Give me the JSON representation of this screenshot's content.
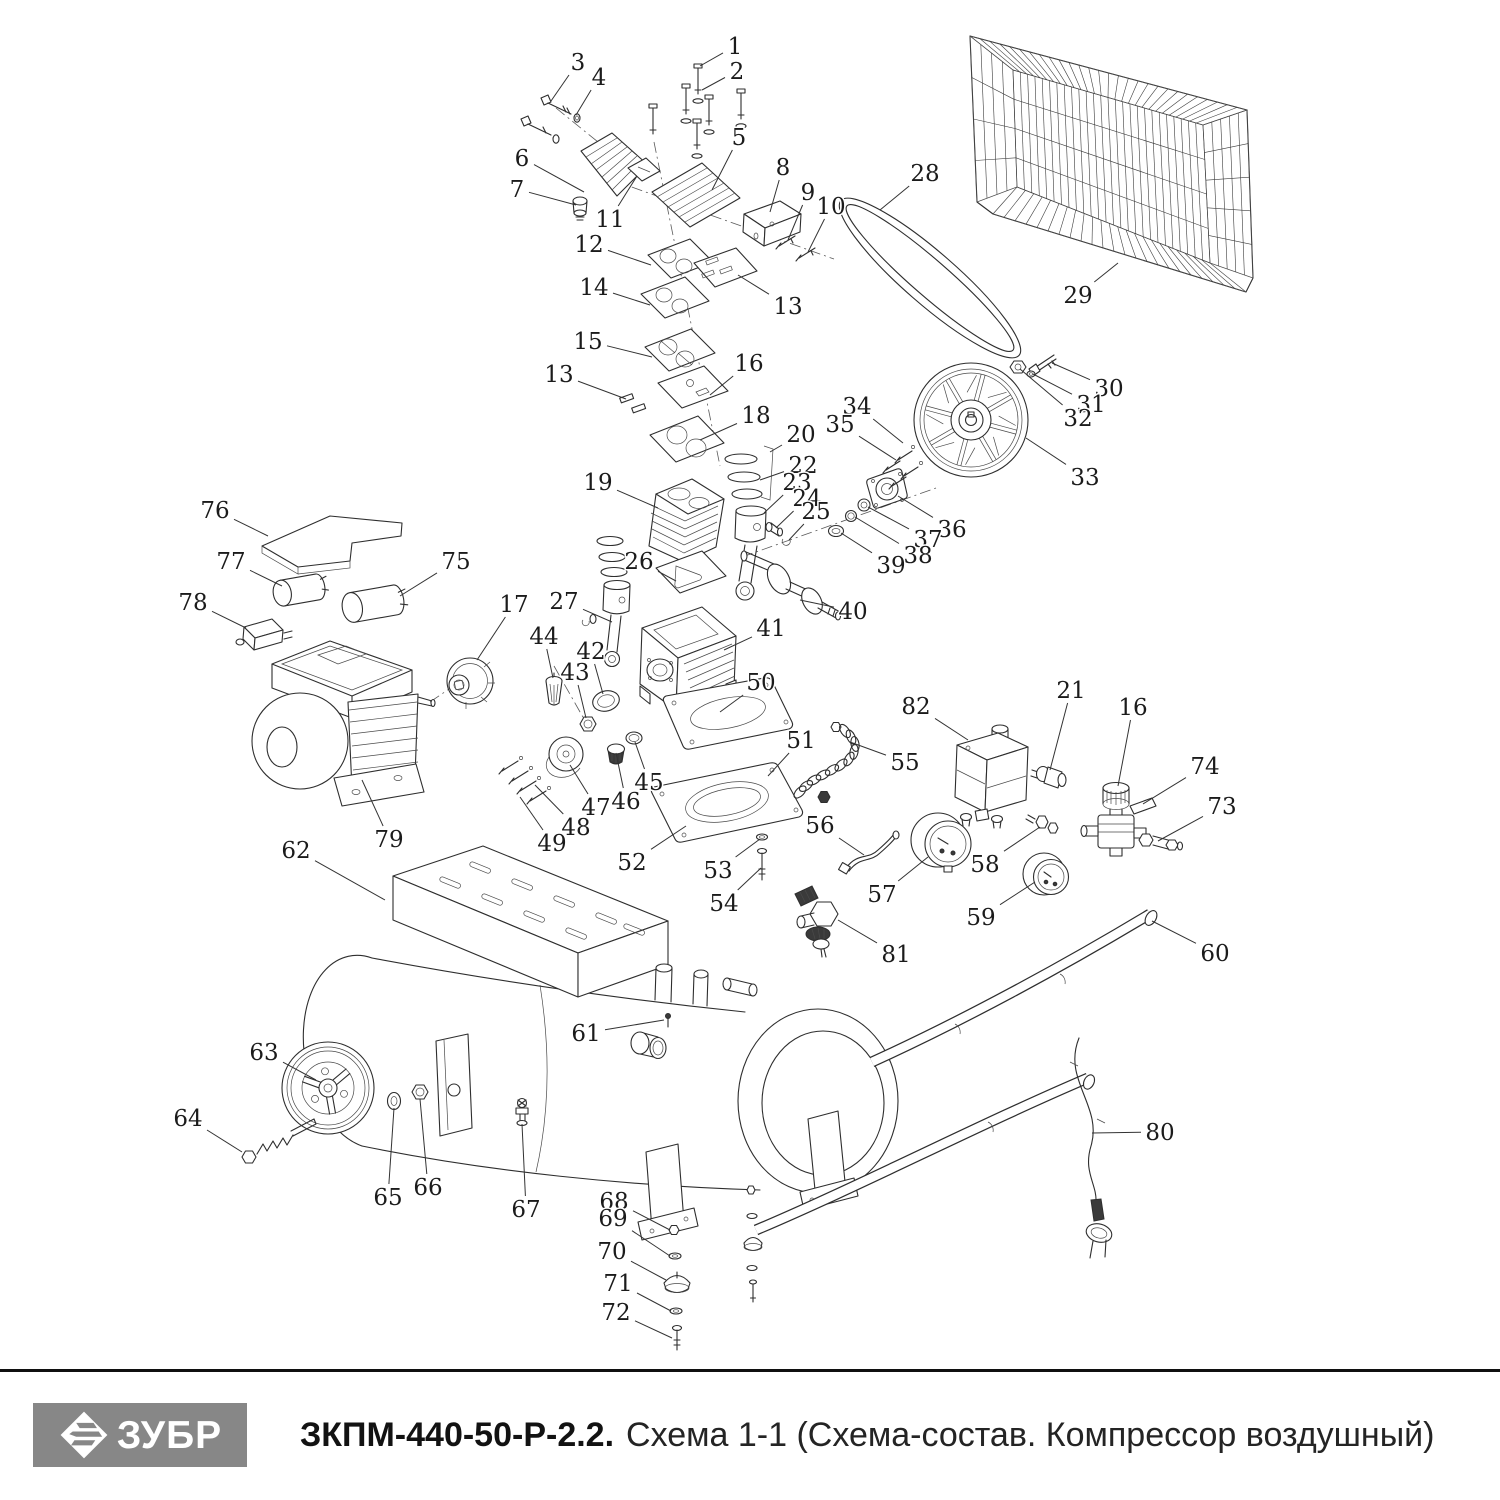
{
  "footer": {
    "brand": "ЗУБР",
    "model": "ЗКПМ-440-50-Р-2.2.",
    "subtitle": "Схема 1-1 (Схема-состав. Компрессор воздушный)"
  },
  "colors": {
    "line": "#2e2e2e",
    "label": "#1b1b1b",
    "logo_bg": "#878787",
    "rule": "#101010"
  },
  "diagram": {
    "description": "Exploded parts view of air compressor",
    "parts": [
      {
        "n": "1",
        "x": 735,
        "y": 46,
        "tx": 700,
        "ty": 66
      },
      {
        "n": "2",
        "x": 737,
        "y": 71,
        "tx": 702,
        "ty": 90
      },
      {
        "n": "3",
        "x": 578,
        "y": 62,
        "tx": 551,
        "ty": 101
      },
      {
        "n": "4",
        "x": 599,
        "y": 77,
        "tx": 576,
        "ty": 115
      },
      {
        "n": "5",
        "x": 739,
        "y": 137,
        "tx": 712,
        "ty": 190
      },
      {
        "n": "6",
        "x": 522,
        "y": 158,
        "tx": 584,
        "ty": 192
      },
      {
        "n": "7",
        "x": 517,
        "y": 189,
        "tx": 576,
        "ty": 205
      },
      {
        "n": "8",
        "x": 783,
        "y": 167,
        "tx": 770,
        "ty": 212
      },
      {
        "n": "9",
        "x": 808,
        "y": 192,
        "tx": 788,
        "ty": 240
      },
      {
        "n": "10",
        "x": 831,
        "y": 206,
        "tx": 808,
        "ty": 252
      },
      {
        "n": "11",
        "x": 610,
        "y": 219,
        "tx": 637,
        "ty": 176
      },
      {
        "n": "12",
        "x": 589,
        "y": 244,
        "tx": 651,
        "ty": 265
      },
      {
        "n": "13",
        "x": 788,
        "y": 306,
        "tx": 738,
        "ty": 275
      },
      {
        "n": "14",
        "x": 594,
        "y": 287,
        "tx": 650,
        "ty": 305
      },
      {
        "n": "15",
        "x": 588,
        "y": 341,
        "tx": 652,
        "ty": 357
      },
      {
        "n": "13",
        "x": 559,
        "y": 374,
        "tx": 626,
        "ty": 399
      },
      {
        "n": "16",
        "x": 749,
        "y": 363,
        "tx": 710,
        "ty": 395
      },
      {
        "n": "18",
        "x": 756,
        "y": 415,
        "tx": 700,
        "ty": 440
      },
      {
        "n": "19",
        "x": 598,
        "y": 482,
        "tx": 658,
        "ty": 508
      },
      {
        "n": "20",
        "x": 801,
        "y": 434,
        "tx": 770,
        "ty": 452
      },
      {
        "n": "22",
        "x": 803,
        "y": 465,
        "tx": 760,
        "ty": 480
      },
      {
        "n": "23",
        "x": 797,
        "y": 482,
        "tx": 764,
        "ty": 513
      },
      {
        "n": "24",
        "x": 807,
        "y": 498,
        "tx": 776,
        "ty": 528
      },
      {
        "n": "25",
        "x": 816,
        "y": 511,
        "tx": 789,
        "ty": 540
      },
      {
        "n": "26",
        "x": 639,
        "y": 561,
        "tx": 676,
        "ty": 581
      },
      {
        "n": "27",
        "x": 564,
        "y": 601,
        "tx": 612,
        "ty": 622
      },
      {
        "n": "28",
        "x": 925,
        "y": 173,
        "tx": 880,
        "ty": 210
      },
      {
        "n": "29",
        "x": 1078,
        "y": 295,
        "tx": 1118,
        "ty": 263
      },
      {
        "n": "30",
        "x": 1109,
        "y": 388,
        "tx": 1052,
        "ty": 363
      },
      {
        "n": "31",
        "x": 1091,
        "y": 404,
        "tx": 1033,
        "ty": 374
      },
      {
        "n": "32",
        "x": 1078,
        "y": 418,
        "tx": 1020,
        "ty": 369
      },
      {
        "n": "33",
        "x": 1085,
        "y": 477,
        "tx": 1026,
        "ty": 438
      },
      {
        "n": "34",
        "x": 857,
        "y": 406,
        "tx": 903,
        "ty": 443
      },
      {
        "n": "35",
        "x": 840,
        "y": 424,
        "tx": 896,
        "ty": 460
      },
      {
        "n": "36",
        "x": 952,
        "y": 529,
        "tx": 898,
        "ty": 496
      },
      {
        "n": "37",
        "x": 928,
        "y": 539,
        "tx": 868,
        "ty": 507
      },
      {
        "n": "38",
        "x": 918,
        "y": 555,
        "tx": 855,
        "ty": 517
      },
      {
        "n": "39",
        "x": 891,
        "y": 565,
        "tx": 841,
        "ty": 533
      },
      {
        "n": "40",
        "x": 853,
        "y": 611,
        "tx": 800,
        "ty": 600
      },
      {
        "n": "41",
        "x": 771,
        "y": 628,
        "tx": 724,
        "ty": 650
      },
      {
        "n": "42",
        "x": 591,
        "y": 651,
        "tx": 603,
        "ty": 694
      },
      {
        "n": "43",
        "x": 575,
        "y": 672,
        "tx": 586,
        "ty": 718
      },
      {
        "n": "44",
        "x": 544,
        "y": 636,
        "tx": 553,
        "ty": 678
      },
      {
        "n": "45",
        "x": 649,
        "y": 782,
        "tx": 635,
        "ty": 742
      },
      {
        "n": "46",
        "x": 626,
        "y": 801,
        "tx": 616,
        "ty": 753
      },
      {
        "n": "47",
        "x": 596,
        "y": 807,
        "tx": 570,
        "ty": 765
      },
      {
        "n": "48",
        "x": 576,
        "y": 827,
        "tx": 535,
        "ty": 785
      },
      {
        "n": "49",
        "x": 552,
        "y": 843,
        "tx": 520,
        "ty": 797
      },
      {
        "n": "50",
        "x": 761,
        "y": 682,
        "tx": 720,
        "ty": 712
      },
      {
        "n": "51",
        "x": 801,
        "y": 740,
        "tx": 768,
        "ty": 776
      },
      {
        "n": "52",
        "x": 632,
        "y": 862,
        "tx": 686,
        "ty": 826
      },
      {
        "n": "53",
        "x": 718,
        "y": 870,
        "tx": 760,
        "ty": 839
      },
      {
        "n": "54",
        "x": 724,
        "y": 903,
        "tx": 761,
        "ty": 868
      },
      {
        "n": "55",
        "x": 905,
        "y": 762,
        "tx": 850,
        "ty": 742
      },
      {
        "n": "56",
        "x": 820,
        "y": 825,
        "tx": 864,
        "ty": 855
      },
      {
        "n": "57",
        "x": 882,
        "y": 894,
        "tx": 928,
        "ty": 857
      },
      {
        "n": "58",
        "x": 985,
        "y": 864,
        "tx": 1040,
        "ty": 827
      },
      {
        "n": "59",
        "x": 981,
        "y": 917,
        "tx": 1035,
        "ty": 882
      },
      {
        "n": "60",
        "x": 1215,
        "y": 953,
        "tx": 1152,
        "ty": 921
      },
      {
        "n": "61",
        "x": 586,
        "y": 1033,
        "tx": 664,
        "ty": 1020
      },
      {
        "n": "62",
        "x": 296,
        "y": 850,
        "tx": 385,
        "ty": 900
      },
      {
        "n": "63",
        "x": 264,
        "y": 1052,
        "tx": 316,
        "ty": 1080
      },
      {
        "n": "64",
        "x": 188,
        "y": 1118,
        "tx": 242,
        "ty": 1152
      },
      {
        "n": "65",
        "x": 388,
        "y": 1197,
        "tx": 394,
        "ty": 1108
      },
      {
        "n": "66",
        "x": 428,
        "y": 1187,
        "tx": 420,
        "ty": 1099
      },
      {
        "n": "67",
        "x": 526,
        "y": 1209,
        "tx": 522,
        "ty": 1124
      },
      {
        "n": "68",
        "x": 614,
        "y": 1201,
        "tx": 670,
        "ty": 1230
      },
      {
        "n": "69",
        "x": 613,
        "y": 1218,
        "tx": 670,
        "ty": 1256
      },
      {
        "n": "70",
        "x": 612,
        "y": 1251,
        "tx": 666,
        "ty": 1280
      },
      {
        "n": "71",
        "x": 618,
        "y": 1283,
        "tx": 671,
        "ty": 1311
      },
      {
        "n": "72",
        "x": 616,
        "y": 1312,
        "tx": 672,
        "ty": 1338
      },
      {
        "n": "73",
        "x": 1222,
        "y": 806,
        "tx": 1158,
        "ty": 841
      },
      {
        "n": "74",
        "x": 1205,
        "y": 766,
        "tx": 1143,
        "ty": 804
      },
      {
        "n": "75",
        "x": 456,
        "y": 561,
        "tx": 400,
        "ty": 596
      },
      {
        "n": "76",
        "x": 215,
        "y": 510,
        "tx": 268,
        "ty": 536
      },
      {
        "n": "77",
        "x": 231,
        "y": 561,
        "tx": 282,
        "ty": 586
      },
      {
        "n": "78",
        "x": 193,
        "y": 602,
        "tx": 246,
        "ty": 628
      },
      {
        "n": "79",
        "x": 389,
        "y": 839,
        "tx": 362,
        "ty": 780
      },
      {
        "n": "80",
        "x": 1160,
        "y": 1132,
        "tx": 1092,
        "ty": 1133
      },
      {
        "n": "81",
        "x": 896,
        "y": 954,
        "tx": 838,
        "ty": 920
      },
      {
        "n": "82",
        "x": 916,
        "y": 706,
        "tx": 968,
        "ty": 740
      },
      {
        "n": "16",
        "x": 1133,
        "y": 707,
        "tx": 1118,
        "ty": 786
      },
      {
        "n": "21",
        "x": 1071,
        "y": 690,
        "tx": 1050,
        "ty": 770
      },
      {
        "n": "17",
        "x": 514,
        "y": 604,
        "tx": 477,
        "ty": 660
      }
    ]
  }
}
